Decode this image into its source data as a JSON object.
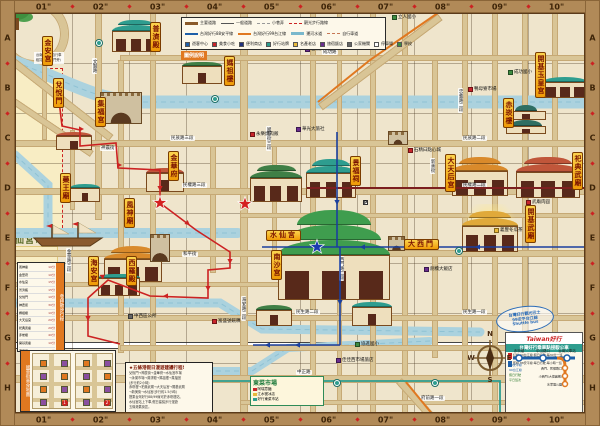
{
  "map": {
    "frame": {
      "top_labels": [
        "01\"",
        "02\"",
        "03\"",
        "04\"",
        "05\"",
        "06\"",
        "07\"",
        "08\"",
        "09\"",
        "10\""
      ],
      "bottom_labels": [
        "01\"",
        "02\"",
        "03\"",
        "04\"",
        "05\"",
        "06\"",
        "07\"",
        "08\"",
        "09\"",
        "10\""
      ],
      "left_labels": [
        "A",
        "B",
        "C",
        "D",
        "E",
        "F",
        "G",
        "H"
      ],
      "right_labels": [
        "A",
        "B",
        "C",
        "D",
        "E",
        "F",
        "G",
        "H"
      ],
      "frame_color": "#b18a58"
    },
    "colors": {
      "background": "#efe5cc",
      "road": "#d9c596",
      "canal": "#abd2de",
      "route_red": "#cc2222",
      "route_blue": "#1a3f9e",
      "route_orange": "#e07820",
      "route_teal": "#2e9d8f",
      "route_dark": "#7c1f1f",
      "plaque": "#f5a623",
      "market_block": "#f8edc4"
    },
    "market_block_label": "水仙宮市場",
    "plaques": [
      {
        "id": "jin-an-gong",
        "text": "金安宮",
        "x": 42,
        "y": 36
      },
      {
        "id": "pu-ji-dian",
        "text": "普濟殿",
        "x": 150,
        "y": 22
      },
      {
        "id": "ma-zu-lou",
        "text": "媽祖樓",
        "x": 224,
        "y": 56
      },
      {
        "id": "dui-yue-men",
        "text": "兌悅門",
        "x": 53,
        "y": 78
      },
      {
        "id": "ji-fu-gong",
        "text": "集福宮",
        "x": 95,
        "y": 97
      },
      {
        "id": "yao-wang-miao",
        "text": "藥王廟",
        "x": 60,
        "y": 173
      },
      {
        "id": "jin-hua-fu",
        "text": "金華府",
        "x": 168,
        "y": 151
      },
      {
        "id": "feng-shen-miao",
        "text": "風神廟",
        "x": 124,
        "y": 198
      },
      {
        "id": "hai-an-gong",
        "text": "海安宮",
        "x": 88,
        "y": 256
      },
      {
        "id": "xi-luo-dian",
        "text": "西羅殿",
        "x": 126,
        "y": 256
      },
      {
        "id": "nan-sha-gong",
        "text": "南沙宮",
        "x": 271,
        "y": 250
      },
      {
        "id": "jing-fu-ci",
        "text": "景福祠",
        "x": 350,
        "y": 156
      },
      {
        "id": "shui-xian-gong",
        "text": "水仙宮",
        "x": 266,
        "y": 230,
        "horizontal": true
      },
      {
        "id": "da-tian-hou-gong",
        "text": "大天后宮",
        "x": 445,
        "y": 154
      },
      {
        "id": "si-dian-wu-miao",
        "text": "祀典武廟",
        "x": 572,
        "y": 152
      },
      {
        "id": "kai-ji-wu-miao",
        "text": "開基武廟",
        "x": 525,
        "y": 205
      },
      {
        "id": "kai-ji-yu-huang-gong",
        "text": "開基玉皇宮",
        "x": 535,
        "y": 52
      },
      {
        "id": "chi-kan-lou",
        "text": "赤崁樓",
        "x": 503,
        "y": 98
      },
      {
        "id": "da-xi-men",
        "text": "大西門",
        "x": 404,
        "y": 239,
        "horizontal": true
      }
    ],
    "temples": [
      {
        "id": "pu-ji-dian",
        "x": 112,
        "y": 14,
        "w": 48,
        "h": 38,
        "roof": "#2e9d8f",
        "type": "t2"
      },
      {
        "id": "ma-zu-lou",
        "x": 182,
        "y": 52,
        "w": 40,
        "h": 32,
        "roof": "#3f7f46",
        "type": "t1"
      },
      {
        "id": "jin-an-gong",
        "x": 56,
        "y": 124,
        "w": 36,
        "h": 26,
        "roof": "#c0563a",
        "type": "t1"
      },
      {
        "id": "dui-yue-men",
        "x": 100,
        "y": 92,
        "w": 40,
        "h": 30,
        "roof": "",
        "type": "gate"
      },
      {
        "id": "yao-wang-miao",
        "x": 70,
        "y": 176,
        "w": 30,
        "h": 26,
        "roof": "#2e9d8f",
        "type": "t1"
      },
      {
        "id": "jin-hua-fu",
        "x": 146,
        "y": 158,
        "w": 38,
        "h": 34,
        "roof": "#c0563a",
        "type": "t1"
      },
      {
        "id": "feng-shen-miao",
        "x": 104,
        "y": 240,
        "w": 58,
        "h": 42,
        "roof": "#d98a2b",
        "type": "t2"
      },
      {
        "id": "jie-guan-ting-arch",
        "x": 150,
        "y": 234,
        "w": 18,
        "h": 26,
        "roof": "",
        "type": "gate"
      },
      {
        "id": "xi-luo-dian",
        "x": 98,
        "y": 264,
        "w": 42,
        "h": 32,
        "roof": "#2e9d8f",
        "type": "t1"
      },
      {
        "id": "yong-le-market-temple",
        "x": 250,
        "y": 158,
        "w": 52,
        "h": 44,
        "roof": "#3f7f46",
        "type": "t2"
      },
      {
        "id": "jing-fu-ci",
        "x": 306,
        "y": 152,
        "w": 50,
        "h": 46,
        "roof": "#2e9d8f",
        "type": "t2"
      },
      {
        "id": "shui-xian-gong",
        "x": 278,
        "y": 200,
        "w": 112,
        "h": 100,
        "roof": "#3f9d4e",
        "type": "t3"
      },
      {
        "id": "nan-sha-gong",
        "x": 256,
        "y": 296,
        "w": 36,
        "h": 30,
        "roof": "#3f7f46",
        "type": "t1"
      },
      {
        "id": "bao-xi-gong",
        "x": 352,
        "y": 292,
        "w": 40,
        "h": 34,
        "roof": "#2e9d8f",
        "type": "t1"
      },
      {
        "id": "da-tian-hou-gong",
        "x": 452,
        "y": 150,
        "w": 56,
        "h": 46,
        "roof": "#d98a2b",
        "type": "t2"
      },
      {
        "id": "si-dian-wu-miao",
        "x": 516,
        "y": 150,
        "w": 64,
        "h": 48,
        "roof": "#c0563a",
        "type": "t2"
      },
      {
        "id": "kai-ji-wu-miao",
        "x": 462,
        "y": 204,
        "w": 56,
        "h": 48,
        "roof": "#e0a93a",
        "type": "rays"
      },
      {
        "id": "kai-ji-yu-huang-gong",
        "x": 543,
        "y": 68,
        "w": 44,
        "h": 30,
        "roof": "#2e9d8f",
        "type": "t1"
      },
      {
        "id": "chi-kan-lou",
        "x": 506,
        "y": 96,
        "w": 40,
        "h": 38,
        "roof": "#2e6e62",
        "type": "pagoda"
      },
      {
        "id": "da-xi-men-gate",
        "x": 388,
        "y": 236,
        "w": 15,
        "h": 13,
        "roof": "",
        "type": "gate"
      },
      {
        "id": "roundabout-castle",
        "x": 388,
        "y": 131,
        "w": 18,
        "h": 12,
        "roof": "",
        "type": "gate"
      }
    ],
    "road_labels": [
      {
        "text": "成功路",
        "x": 322,
        "y": 50
      },
      {
        "text": "民族路三段",
        "x": 170,
        "y": 136
      },
      {
        "text": "民族路二段",
        "x": 462,
        "y": 136
      },
      {
        "text": "民權路三段",
        "x": 182,
        "y": 183
      },
      {
        "text": "民權路二段",
        "x": 462,
        "y": 183
      },
      {
        "text": "民生路二段",
        "x": 295,
        "y": 310
      },
      {
        "text": "民生路一段",
        "x": 462,
        "y": 310
      },
      {
        "text": "中正路",
        "x": 296,
        "y": 370
      },
      {
        "text": "府前路一段",
        "x": 420,
        "y": 396
      },
      {
        "text": "海安路二段",
        "x": 241,
        "y": 296,
        "v": true
      },
      {
        "text": "國華街三段",
        "x": 266,
        "y": 126,
        "v": true
      },
      {
        "text": "西門路二段",
        "x": 339,
        "y": 256,
        "v": true
      },
      {
        "text": "忠義路二段",
        "x": 458,
        "y": 88,
        "v": true
      },
      {
        "text": "新美街",
        "x": 430,
        "y": 158,
        "v": true
      },
      {
        "text": "金華路三段",
        "x": 66,
        "y": 248,
        "v": true
      },
      {
        "text": "文賢路",
        "x": 92,
        "y": 58,
        "v": true
      },
      {
        "text": "神農街",
        "x": 100,
        "y": 146
      },
      {
        "text": "和平街",
        "x": 182,
        "y": 252
      }
    ],
    "pois": [
      {
        "color": "#c9252b",
        "label": "永樂燒肉飯",
        "x": 250,
        "y": 131
      },
      {
        "color": "#c9252b",
        "label": "富盛號碗粿",
        "x": 212,
        "y": 318
      },
      {
        "color": "#c9252b",
        "label": "石精臼點心城",
        "x": 408,
        "y": 147
      },
      {
        "color": "#c9252b",
        "label": "鴨母寮市場",
        "x": 468,
        "y": 86
      },
      {
        "color": "#c9252b",
        "label": "武廟肉圓",
        "x": 526,
        "y": 199
      },
      {
        "color": "#6a2d8e",
        "label": "台南大飯店",
        "x": 305,
        "y": 46
      },
      {
        "color": "#6a2d8e",
        "label": "華光大旅社",
        "x": 296,
        "y": 126
      },
      {
        "color": "#6a2d8e",
        "label": "劍橋大飯店",
        "x": 424,
        "y": 266
      },
      {
        "color": "#6a2d8e",
        "label": "佳佳西市場旅店",
        "x": 336,
        "y": 357
      },
      {
        "color": "#3d8c40",
        "label": "立人國小",
        "x": 392,
        "y": 14
      },
      {
        "color": "#3d8c40",
        "label": "成功國小",
        "x": 508,
        "y": 69
      },
      {
        "color": "#3d8c40",
        "label": "協進國小",
        "x": 355,
        "y": 341
      },
      {
        "color": "#e8b93a",
        "label": "義豐冬瓜茶",
        "x": 494,
        "y": 227
      },
      {
        "color": "#666666",
        "label": "中西區公所",
        "x": 128,
        "y": 313
      },
      {
        "color": "#ffffff",
        "label": "停車場",
        "glyph": "P",
        "x": 363,
        "y": 200
      },
      {
        "color": "#ffffff",
        "label": "停車場",
        "glyph": "P",
        "x": 540,
        "y": 342
      }
    ],
    "bus_stops": [
      {
        "x": 96,
        "y": 40
      },
      {
        "x": 212,
        "y": 96
      },
      {
        "x": 258,
        "y": 380
      },
      {
        "x": 334,
        "y": 380
      },
      {
        "x": 432,
        "y": 380
      },
      {
        "x": 456,
        "y": 248
      }
    ],
    "route_pill": "630",
    "legend": {
      "tab": "圖例說明",
      "lines": [
        {
          "label": "主要道路",
          "color": "#8a5a2a",
          "style": "solid3"
        },
        {
          "label": "一般道路",
          "color": "#555555",
          "style": "solid1"
        },
        {
          "label": "小巷弄",
          "color": "#999999",
          "style": "dash"
        },
        {
          "label": "觀光步行路線",
          "color": "#cc2222",
          "style": "dash"
        },
        {
          "label": "台灣好行88安平線",
          "color": "#1e5fa8",
          "style": "solid2"
        },
        {
          "label": "台灣好行99台江線",
          "color": "#e07820",
          "style": "solid2"
        },
        {
          "label": "運河水道",
          "color": "#7ab8cc",
          "style": "solid3"
        },
        {
          "label": "自行車道",
          "color": "#c77755",
          "style": "dash"
        }
      ],
      "icons": [
        {
          "color": "#1e5fa8",
          "label": "遊客中心"
        },
        {
          "color": "#c9252b",
          "label": "美食小吃"
        },
        {
          "color": "#20317e",
          "label": "便利商店"
        },
        {
          "color": "#2e9d8f",
          "label": "好行站牌"
        },
        {
          "color": "#e8b93a",
          "label": "名產老店"
        },
        {
          "color": "#6a2d8e",
          "label": "旅宿飯店"
        },
        {
          "color": "#666666",
          "label": "公家機關"
        },
        {
          "color": "#ffffff",
          "label": "停車場"
        },
        {
          "color": "#3d8c40",
          "label": "學校"
        }
      ]
    },
    "bike_note": [
      "台南市公共自行車",
      "租賃站(兌悅門旁)"
    ],
    "itinerary_box": {
      "title": "參拜散步行程",
      "rows": [
        [
          "風神廟",
          "10分"
        ],
        [
          "金華府",
          "10分"
        ],
        [
          "水仙宮",
          "15分"
        ],
        [
          "普濟殿",
          "15分"
        ],
        [
          "兌悅門",
          "10分"
        ],
        [
          "神農街",
          "30分"
        ],
        [
          "媽祖樓",
          "10分"
        ],
        [
          "大天后宮",
          "20分"
        ],
        [
          "祀典武廟",
          "20分"
        ],
        [
          "赤崁樓",
          "40分"
        ],
        [
          "開基武廟",
          "10分"
        ],
        [
          "西羅殿",
          "10分"
        ],
        [
          "藥王廟",
          "10分"
        ]
      ]
    },
    "food_inset": {
      "title": "國華街美食地圖",
      "panel_count": 2
    },
    "note_box": {
      "title": "★五條港假日漫遊建議行程!",
      "lines": [
        "兌悅門→神農街→金華府→水仙宮市場",
        "→永樂市場→普濟殿→媽祖樓→集福宮",
        "(步行約2小時)",
        "赤崁樓→祀典武廟→大天后宮→開基武廟",
        "→新美街→水仙宮(步行約1.5小時)",
        "搭乘台灣好行88/99線可於赤崁樓站、",
        "水仙宮站上下車,假日建議步行漫遊",
        "五條港舊街區。"
      ]
    },
    "east_market_box": {
      "title": "東菜市場",
      "rows": [
        "阿瑞意麵",
        "江水號冰店",
        "好行東菜市站"
      ]
    },
    "yellow_poi_block": {
      "rows": [
        "保西宮",
        "沙淘宮",
        "下大道米糕"
      ]
    },
    "transit_box": {
      "brand": "Taiwan好行",
      "title": "台灣好行乘車點接駁公車",
      "blue_stops": [
        "赤崁樓",
        "中山路口",
        "台南火車站"
      ],
      "orange_stops": [
        "西門、民權路口",
        "小西門(大億麗緻)",
        "水萍塭公園"
      ],
      "side_list": [
        "88安平線",
        "99台江線",
        "假日行駛",
        "平日班次"
      ],
      "note_red": "紅線 99台江線:假日行駛,每30分一班",
      "note_blue": "藍線 88安平線:每日行駛,每小時一班"
    },
    "stamp": [
      "台灣好行觀光巴士",
      "99安平台江線",
      "Shuttle bus"
    ],
    "compass": {
      "n": "N",
      "s": "S",
      "e": "E",
      "w": "W"
    }
  }
}
